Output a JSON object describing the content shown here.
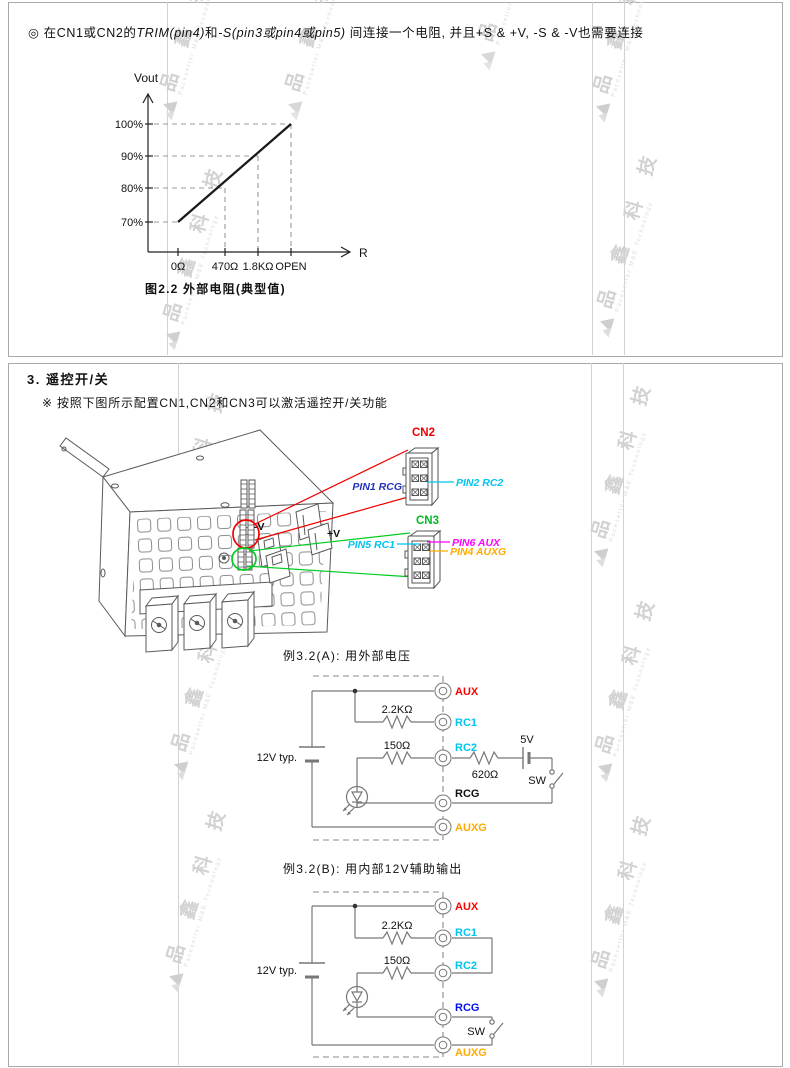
{
  "watermark": {
    "text": "品 鑫 科 技",
    "subtext": "Pacesetter M&E Technology"
  },
  "note": {
    "bullet": "◎",
    "part1": "在CN1或CN2的",
    "italic1": "TRIM(pin4)",
    "part2": "和",
    "italic2": "-S(pin3或pin4或pin5)",
    "part3": " 间连接一个电阻, 并且+S & +V, -S & -V也需要连接"
  },
  "chart": {
    "ylabel": "Vout",
    "xlabel": "R",
    "yticks": [
      "100%",
      "90%",
      "80%",
      "70%"
    ],
    "xticks": [
      "0Ω",
      "470Ω",
      "1.8KΩ",
      "OPEN"
    ],
    "caption": "图2.2 外部电阻(典型值)"
  },
  "chart_data": {
    "type": "line",
    "title": "图2.2 外部电阻(典型值)",
    "xlabel": "R",
    "ylabel": "Vout",
    "x_ticks": [
      "0Ω",
      "470Ω",
      "1.8KΩ",
      "OPEN"
    ],
    "y_ticks": [
      "70%",
      "80%",
      "90%",
      "100%"
    ],
    "points": [
      {
        "r": "0Ω",
        "vout_pct": 70
      },
      {
        "r": "470Ω",
        "vout_pct": 80
      },
      {
        "r": "1.8KΩ",
        "vout_pct": 90
      },
      {
        "r": "OPEN",
        "vout_pct": 100
      }
    ],
    "ylim": [
      60,
      110
    ],
    "grid": "dashed guide lines from each point to both axes",
    "legend": "none"
  },
  "section3": {
    "heading": "3. 遥控开/关",
    "note": "※ 按照下图所示配置CN1,CN2和CN3可以激活遥控开/关功能",
    "psu": {
      "cn2": "CN2",
      "cn3": "CN3",
      "pin1": "PIN1 RCG",
      "pin2": "PIN2 RC2",
      "pin5": "PIN5 RC1",
      "pin6": "PIN6 AUX",
      "pin4": "PIN4 AUXG",
      "neg": "-V",
      "pos": "+V"
    },
    "ex_a": {
      "title": "例3.2(A): 用外部电压",
      "r1": "2.2KΩ",
      "r2": "150Ω",
      "r3": "620Ω",
      "v": "5V",
      "sw": "SW",
      "src": "12V typ.",
      "t": [
        "AUX",
        "RC1",
        "RC2",
        "RCG",
        "AUXG"
      ]
    },
    "ex_b": {
      "title": "例3.2(B): 用内部12V辅助输出",
      "r1": "2.2KΩ",
      "r2": "150Ω",
      "sw": "SW",
      "src": "12V typ.",
      "t": [
        "AUX",
        "RC1",
        "RC2",
        "RCG",
        "AUXG"
      ]
    }
  },
  "colors": {
    "red": "#ff0000",
    "green": "#00bb22",
    "cyan": "#00c5ee",
    "magenta": "#ff00ff",
    "orange": "#ffaa00",
    "navy": "#2233bb",
    "blue": "#0011ee",
    "wire_gray": "#888888"
  }
}
